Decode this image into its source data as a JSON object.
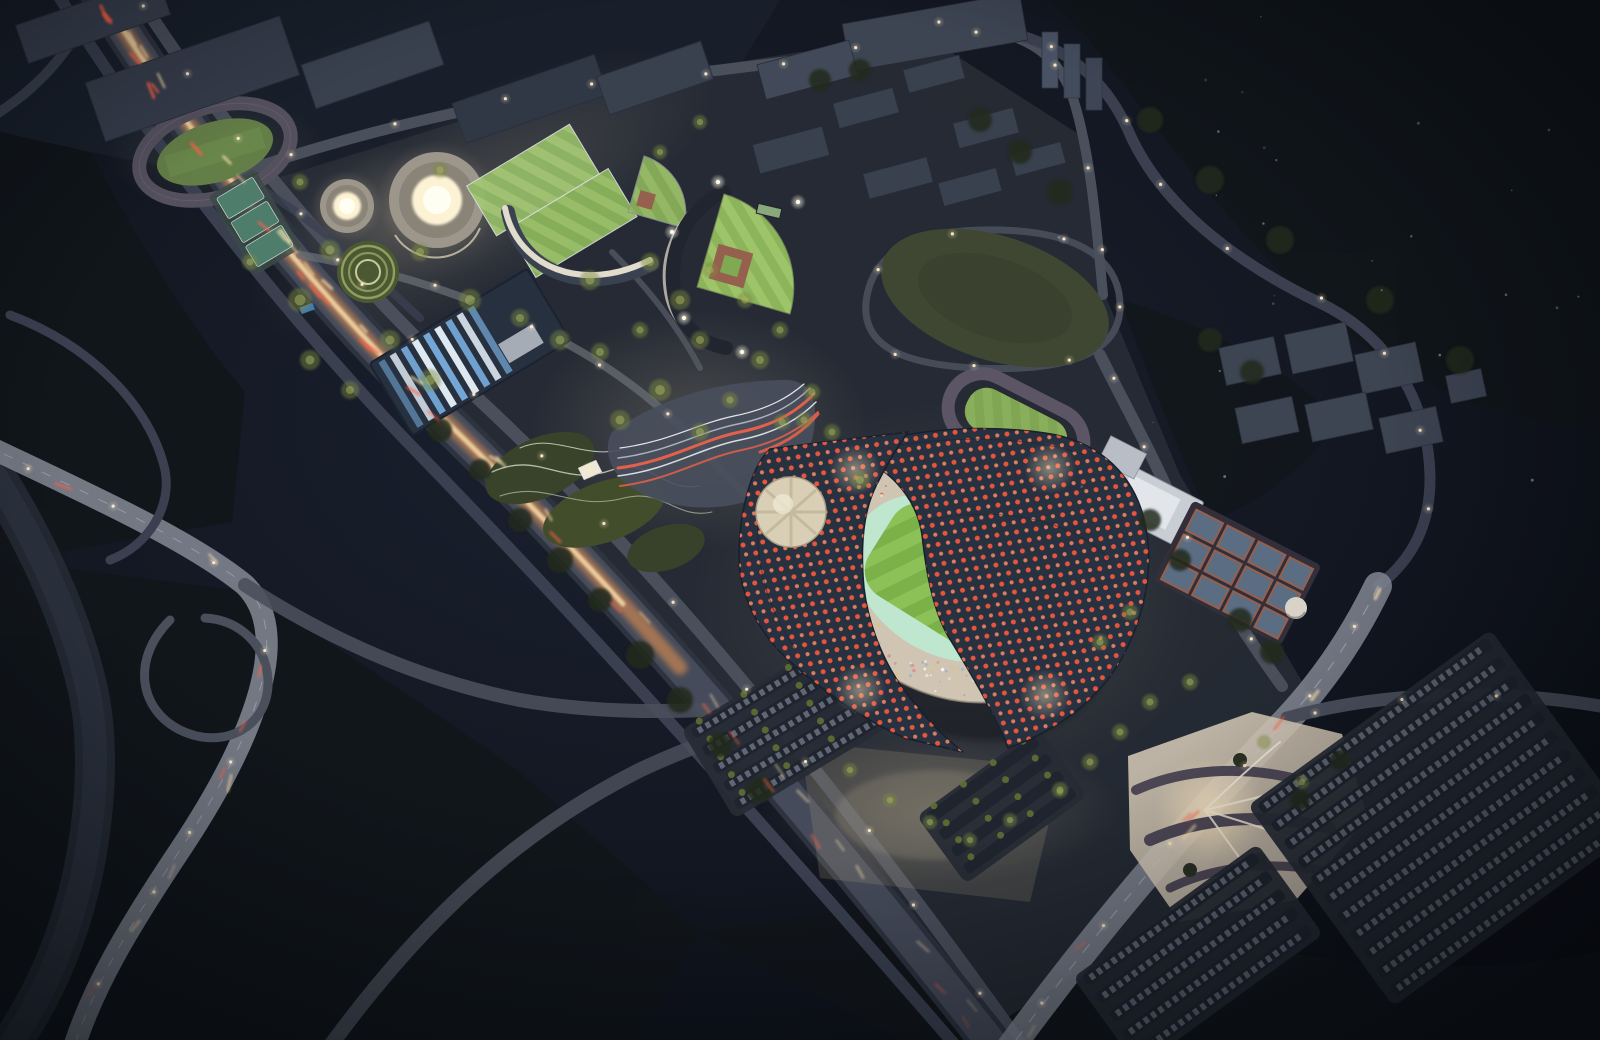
{
  "meta": {
    "title": "Aerial night rendering of a sports park masterplan",
    "type": "architectural-rendering",
    "time_of_day": "night",
    "view": "oblique aerial"
  },
  "palette": {
    "sky_hi": "#1b2130",
    "sky_lo": "#0a0d13",
    "city_dark": "#1a202b",
    "site_ground": "#262b35",
    "forest": "#11161a",
    "forest_light": "#1d2620",
    "river": "#252a35",
    "road": "#4a4f5c",
    "road_bright": "#858a97",
    "road_dim": "#3a4050",
    "exp_base": "#2e3340",
    "traffic_glow": "#ff9d4f",
    "traffic_core": "#ffe3b0",
    "taillight": "#ff6248",
    "headlight": "#ffe2ae",
    "lane": "#c9ccd6",
    "roof": "#273140",
    "roof_edge": "#18202c",
    "dot_red": "#e8543c",
    "dot_light": "#ff8a64",
    "medallion": "#d9cfb6",
    "stand": "#cfc5b2",
    "track_mint": "#bfe7cf",
    "pitch_a": "#8cc158",
    "pitch_b": "#7ab148",
    "field_a": "#9ec46a",
    "field_b": "#8bb45b",
    "grandstand": "#e2dccd",
    "donut_body": "#9d968a",
    "donut_glow": "#fdf3d4",
    "donut_core": "#fffef2",
    "amphi_base": "#4c5734",
    "amphi_ring": "#9eab66",
    "aqua_dark": "#26303f",
    "aqua_blue": "#79aede",
    "aqua_white": "#e8f2fb",
    "plaza": "#494e5c",
    "ribbon_red": "#e3604a",
    "ribbon_white": "#d9dde2",
    "lawn": "#3f4733",
    "ptrack": "#5c5565",
    "ptrack_infield": "#74974e",
    "annex": "#c9cdd4",
    "court_blue": "#5a6d83",
    "court_clay": "#96604e",
    "parking": "#262b35",
    "car": "#aeb9cc",
    "glowplaza": "#d8cbb8",
    "tree_lit": "#7d8c42",
    "tree_dark": "#202a1b",
    "building": "#39414f",
    "light_warm": "#ffe9c0"
  },
  "scene": {
    "labels": {
      "title": "Sports park at night — aerial rendering",
      "main_stadium": "Main stadium with sweeping wave-form roof",
      "stadium_roof_west": "West roof wing — dark shell with red skylight dots",
      "stadium_roof_east": "East roof wing — dark shell with red skylight dots",
      "skylight_medallion": "Circular mosaic skylight on roof",
      "pitch": "Illuminated striped football pitch",
      "running_track_ring": "Mint running track ring",
      "grandstands": "Stadium grandstands with crowd",
      "athletics_track_nw": "Athletics practice track (north-west)",
      "tennis_courts_nw": "Outdoor courts (north-west)",
      "small_arena": "Small round gymnasium with glowing oculus",
      "large_arena": "Large round gymnasium with glowing oculus",
      "amphitheater_garden": "Terraced circular amphitheater garden",
      "training_field_1": "Floodlit training field 1",
      "training_field_2": "Floodlit training field 2",
      "grandstand_building": "Curved grandstand building",
      "baseball_field_small": "Small baseball practice diamond",
      "baseball_stadium": "Baseball stadium with floodlights",
      "aquatic_center": "Aquatic center with blue sawtooth roof",
      "festival_plaza": "Festival plaza with flowing striped paving",
      "landform_park": "Wavy landform park with pavilion",
      "great_lawn": "Great oval lawn",
      "practice_track": "Warm-up running track (east)",
      "annex_building": "White sports annex building",
      "tennis_courts_east": "Court cluster east of stadium",
      "service_dome": "Small white service dome",
      "expressway": "Elevated expressway with traffic light trails",
      "arterial_road": "Arterial road and river bridge",
      "river": "River corridor",
      "avenue": "Tree-lined avenue",
      "parking_main": "Main visitor parking lot",
      "city_blocks_north": "Campus blocks north of the park",
      "warehouses_nw": "Industrial rooftops north-west",
      "apartments_east": "Apartment blocks east",
      "towers_ne": "Residential towers north-east",
      "glow_plaza": "Illuminated entry plaza south-east",
      "south_plaza": "South forecourt with tree bosque",
      "ramp_loop": "Highway loop ramp",
      "lights": "Street lights",
      "traffic": "Vehicle light streaks",
      "stars": "Distant specks of light",
      "trees": "Illuminated tree clusters"
    }
  },
  "config": {
    "seed": 1234,
    "crowd": {
      "count": 170,
      "colors": [
        "#f2ead8",
        "#e08898",
        "#95aed0",
        "#e8c05a",
        "#ffffff",
        "#d86a5a"
      ]
    },
    "lamps": {
      "step": 95,
      "dot": "#ffeccb"
    },
    "traffic": {
      "roads": [
        {
          "sel": "#expwy-c",
          "n": 46,
          "spread": 8
        },
        {
          "sel": "#art-c",
          "n": 10,
          "spread": 5
        },
        {
          "sel": "#ave-c",
          "n": 8,
          "spread": 6
        }
      ]
    },
    "stars": {
      "count": 26,
      "color": "#cfd8e8"
    },
    "parking_lots": [
      {
        "cx": 1442,
        "cy": 818,
        "w": 300,
        "h": 248,
        "rot": -36,
        "rows": 11,
        "cars": true,
        "trees": false
      },
      {
        "cx": 792,
        "cy": 724,
        "w": 196,
        "h": 104,
        "rot": -31,
        "rows": 5,
        "cars": true,
        "trees": true
      },
      {
        "cx": 1198,
        "cy": 956,
        "w": 228,
        "h": 112,
        "rot": -36,
        "rows": 5,
        "cars": true,
        "trees": false
      },
      {
        "cx": 1002,
        "cy": 806,
        "w": 150,
        "h": 84,
        "rot": -36,
        "rows": 4,
        "cars": false,
        "trees": true
      }
    ],
    "trees_lit": [
      [
        330,
        250,
        10
      ],
      [
        300,
        300,
        12
      ],
      [
        420,
        252,
        9
      ],
      [
        470,
        300,
        11
      ],
      [
        520,
        318,
        9
      ],
      [
        560,
        340,
        10
      ],
      [
        600,
        352,
        9
      ],
      [
        640,
        330,
        8
      ],
      [
        680,
        300,
        10
      ],
      [
        700,
        340,
        9
      ],
      [
        660,
        390,
        11
      ],
      [
        620,
        420,
        10
      ],
      [
        700,
        432,
        9
      ],
      [
        730,
        400,
        8
      ],
      [
        760,
        360,
        9
      ],
      [
        780,
        330,
        8
      ],
      [
        745,
        300,
        8
      ],
      [
        710,
        270,
        8
      ],
      [
        650,
        262,
        9
      ],
      [
        590,
        280,
        10
      ],
      [
        430,
        380,
        11
      ],
      [
        390,
        340,
        10
      ],
      [
        350,
        390,
        9
      ],
      [
        310,
        360,
        10
      ],
      [
        860,
        480,
        9
      ],
      [
        832,
        432,
        8
      ],
      [
        804,
        420,
        8
      ],
      [
        850,
        770,
        7
      ],
      [
        890,
        800,
        7
      ],
      [
        930,
        822,
        7
      ],
      [
        970,
        840,
        7
      ],
      [
        1010,
        820,
        7
      ],
      [
        1060,
        790,
        8
      ],
      [
        1090,
        762,
        8
      ],
      [
        1120,
        732,
        8
      ],
      [
        1150,
        702,
        8
      ],
      [
        1190,
        682,
        8
      ],
      [
        440,
        170,
        8
      ],
      [
        300,
        182,
        8
      ],
      [
        250,
        262,
        8
      ],
      [
        660,
        152,
        7
      ],
      [
        700,
        122,
        7
      ],
      [
        782,
        422,
        8
      ],
      [
        812,
        392,
        8
      ],
      [
        1100,
        642,
        8
      ],
      [
        1130,
        612,
        8
      ],
      [
        1264,
        742,
        7
      ],
      [
        1302,
        782,
        7
      ]
    ],
    "trees_dark": [
      [
        520,
        520,
        12
      ],
      [
        560,
        560,
        13
      ],
      [
        600,
        600,
        12
      ],
      [
        640,
        655,
        14
      ],
      [
        680,
        700,
        13
      ],
      [
        480,
        470,
        11
      ],
      [
        440,
        430,
        12
      ],
      [
        720,
        745,
        12
      ],
      [
        760,
        790,
        13
      ],
      [
        980,
        120,
        12
      ],
      [
        1020,
        152,
        12
      ],
      [
        1060,
        192,
        13
      ],
      [
        820,
        80,
        11
      ],
      [
        860,
        70,
        11
      ],
      [
        1240,
        620,
        12
      ],
      [
        1272,
        652,
        12
      ],
      [
        1180,
        560,
        11
      ],
      [
        1150,
        520,
        11
      ],
      [
        1210,
        340,
        12
      ],
      [
        1252,
        372,
        12
      ],
      [
        1340,
        760,
        10
      ],
      [
        1300,
        800,
        10
      ],
      [
        1150,
        120,
        13
      ],
      [
        1210,
        180,
        14
      ],
      [
        1280,
        240,
        14
      ],
      [
        1380,
        300,
        14
      ],
      [
        1460,
        360,
        14
      ]
    ]
  }
}
